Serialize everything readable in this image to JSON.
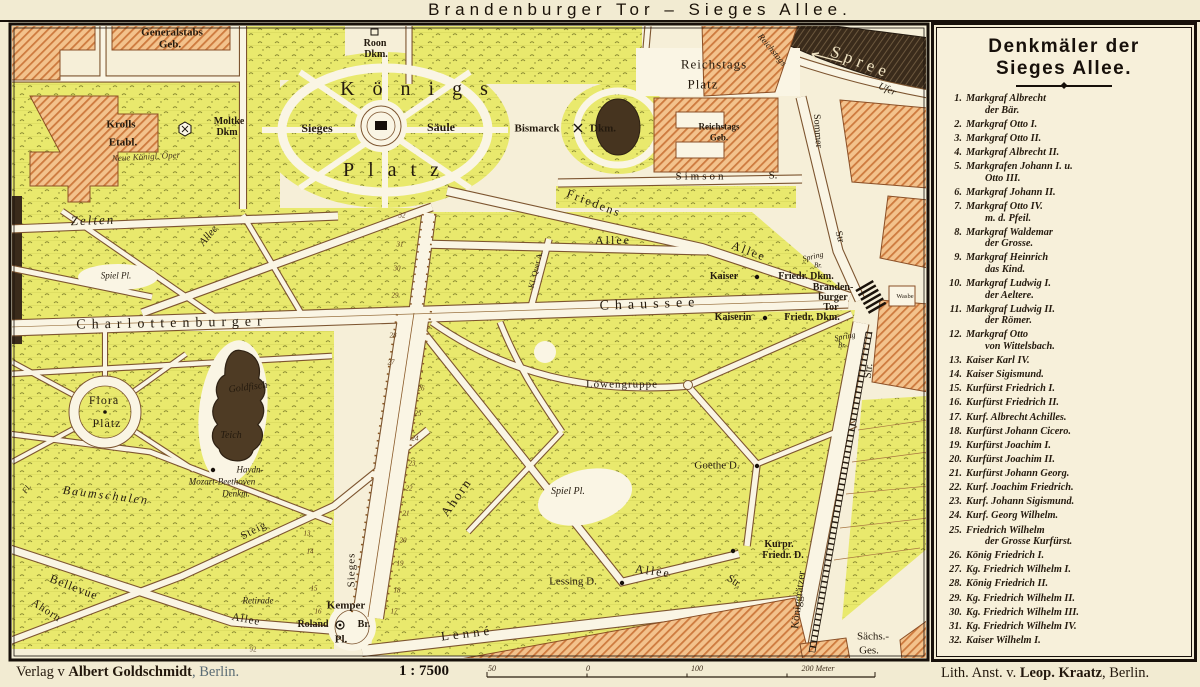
{
  "title": "Brandenburger Tor  –  Sieges Allee.",
  "legend": {
    "title_line1": "Denkmäler der",
    "title_line2": "Sieges Allee.",
    "items": [
      {
        "num": "1.",
        "lines": [
          "Markgraf Albrecht",
          "der Bär."
        ]
      },
      {
        "num": "2.",
        "lines": [
          "Markgraf Otto I."
        ]
      },
      {
        "num": "3.",
        "lines": [
          "Markgraf Otto II."
        ]
      },
      {
        "num": "4.",
        "lines": [
          "Markgraf Albrecht II."
        ]
      },
      {
        "num": "5.",
        "lines": [
          "Markgrafen Johann I. u.",
          "Otto III."
        ]
      },
      {
        "num": "6.",
        "lines": [
          "Markgraf Johann II."
        ]
      },
      {
        "num": "7.",
        "lines": [
          "Markgraf Otto IV.",
          "m. d. Pfeil."
        ]
      },
      {
        "num": "8.",
        "lines": [
          "Markgraf Waldemar",
          "der Grosse."
        ]
      },
      {
        "num": "9.",
        "lines": [
          "Markgraf Heinrich",
          "das Kind."
        ]
      },
      {
        "num": "10.",
        "lines": [
          "Markgraf Ludwig I.",
          "der Aeltere."
        ]
      },
      {
        "num": "11.",
        "lines": [
          "Markgraf Ludwig II.",
          "der Römer."
        ]
      },
      {
        "num": "12.",
        "lines": [
          "Markgraf Otto",
          "von Wittelsbach."
        ]
      },
      {
        "num": "13.",
        "lines": [
          "Kaiser Karl IV."
        ]
      },
      {
        "num": "14.",
        "lines": [
          "Kaiser Sigismund."
        ]
      },
      {
        "num": "15.",
        "lines": [
          "Kurfürst Friedrich I."
        ]
      },
      {
        "num": "16.",
        "lines": [
          "Kurfürst Friedrich II."
        ]
      },
      {
        "num": "17.",
        "lines": [
          "Kurf. Albrecht Achilles."
        ]
      },
      {
        "num": "18.",
        "lines": [
          "Kurfürst Johann Cicero."
        ]
      },
      {
        "num": "19.",
        "lines": [
          "Kurfürst Joachim I."
        ]
      },
      {
        "num": "20.",
        "lines": [
          "Kurfürst Joachim II."
        ]
      },
      {
        "num": "21.",
        "lines": [
          "Kurfürst Johann Georg."
        ]
      },
      {
        "num": "22.",
        "lines": [
          "Kurf. Joachim Friedrich."
        ]
      },
      {
        "num": "23.",
        "lines": [
          "Kurf. Johann Sigismund."
        ]
      },
      {
        "num": "24.",
        "lines": [
          "Kurf. Georg Wilhelm."
        ]
      },
      {
        "num": "25.",
        "lines": [
          "Friedrich Wilhelm",
          "der Grosse Kurfürst."
        ]
      },
      {
        "num": "26.",
        "lines": [
          "König Friedrich I."
        ]
      },
      {
        "num": "27.",
        "lines": [
          "Kg. Friedrich Wilhelm I."
        ]
      },
      {
        "num": "28.",
        "lines": [
          "König Friedrich II."
        ]
      },
      {
        "num": "29.",
        "lines": [
          "Kg. Friedrich Wilhelm II."
        ]
      },
      {
        "num": "30.",
        "lines": [
          "Kg. Friedrich Wilhelm III."
        ]
      },
      {
        "num": "31.",
        "lines": [
          "Kg. Friedrich Wilhelm IV."
        ]
      },
      {
        "num": "32.",
        "lines": [
          "Kaiser Wilhelm I."
        ]
      }
    ]
  },
  "footer": {
    "publisher_pre": "Verlag v ",
    "publisher_bold": "Albert Goldschmidt",
    "publisher_post": ", Berlin.",
    "scale_label": "1 : 7500",
    "ticks": [
      {
        "t": "50",
        "x": 492
      },
      {
        "t": "0",
        "x": 588
      },
      {
        "t": "100",
        "x": 697
      },
      {
        "t": "200 Meter",
        "x": 818
      }
    ],
    "lith_pre": "Lith. Anst. v. ",
    "lith_bold": "Leop. Kraatz",
    "lith_post": ", Berlin."
  },
  "colors": {
    "park": "#e9e96d",
    "building": "#f3c28c",
    "building_hatch": "#cd7a3e",
    "water": "#3a2b1b",
    "road": "#faf5e4",
    "linework": "#7d5530",
    "frame": "#17100a"
  },
  "map_labels": [
    {
      "t": "Generalstabs",
      "x": 172,
      "y": 33,
      "s": 11,
      "b": 1
    },
    {
      "t": "Geb.",
      "x": 170,
      "y": 45,
      "s": 11,
      "b": 1
    },
    {
      "t": "Roon",
      "x": 375,
      "y": 44,
      "s": 10,
      "b": 1
    },
    {
      "t": "Dkm.",
      "x": 376,
      "y": 55,
      "s": 10,
      "b": 1
    },
    {
      "t": "Königs",
      "x": 423,
      "y": 89,
      "s": 20,
      "ls": 18
    },
    {
      "t": "Platz",
      "x": 398,
      "y": 170,
      "s": 20,
      "ls": 14
    },
    {
      "t": "Sieges",
      "x": 317,
      "y": 128,
      "s": 12,
      "b": 1
    },
    {
      "t": "Säule",
      "x": 441,
      "y": 127,
      "s": 12,
      "b": 1
    },
    {
      "t": "Bismarck",
      "x": 537,
      "y": 129,
      "s": 11,
      "b": 1
    },
    {
      "t": "Dkm.",
      "x": 603,
      "y": 129,
      "s": 11,
      "b": 1
    },
    {
      "t": "Reichstags",
      "x": 714,
      "y": 64,
      "s": 13,
      "ls": 1
    },
    {
      "t": "Platz",
      "x": 703,
      "y": 84,
      "s": 13,
      "ls": 1
    },
    {
      "t": "Reichstags",
      "x": 719,
      "y": 127,
      "s": 9,
      "b": 1
    },
    {
      "t": "Geb.",
      "x": 719,
      "y": 138,
      "s": 9,
      "b": 1
    },
    {
      "t": "Simson",
      "x": 701,
      "y": 177,
      "s": 11,
      "ls": 3
    },
    {
      "t": "S.",
      "x": 773,
      "y": 176,
      "s": 11
    },
    {
      "t": "Krolls",
      "x": 121,
      "y": 125,
      "s": 11,
      "b": 1
    },
    {
      "t": "Etabl.",
      "x": 123,
      "y": 143,
      "s": 11,
      "b": 1
    },
    {
      "t": "Neue Königl. Oper",
      "x": 146,
      "y": 157,
      "s": 9,
      "i": 1,
      "rot": -3,
      "c": "#4a3a22"
    },
    {
      "t": "Moltke",
      "x": 229,
      "y": 122,
      "s": 10,
      "b": 1
    },
    {
      "t": "Dkm",
      "x": 227,
      "y": 133,
      "s": 10,
      "b": 1
    },
    {
      "t": "Spree",
      "x": 861,
      "y": 62,
      "s": 17,
      "ls": 5,
      "rot": 21,
      "c": "#efe3c2"
    },
    {
      "t": "Reichstags",
      "x": 772,
      "y": 50,
      "s": 9,
      "rot": 50,
      "i": 1
    },
    {
      "t": "Ufer",
      "x": 887,
      "y": 90,
      "s": 10,
      "rot": 24,
      "i": 1
    },
    {
      "t": "Sommer",
      "x": 817,
      "y": 131,
      "s": 10,
      "rot": 86
    },
    {
      "t": "Str",
      "x": 839,
      "y": 237,
      "s": 10,
      "rot": 75
    },
    {
      "t": "Zelten",
      "x": 93,
      "y": 220,
      "s": 13,
      "i": 1,
      "ls": 2,
      "rot": -2
    },
    {
      "t": "Allee",
      "x": 209,
      "y": 236,
      "s": 11,
      "i": 1,
      "rot": -50
    },
    {
      "t": "Friedens",
      "x": 594,
      "y": 203,
      "s": 12,
      "ls": 2,
      "rot": 21
    },
    {
      "t": "Allee",
      "x": 613,
      "y": 240,
      "s": 12,
      "ls": 2
    },
    {
      "t": "Allee",
      "x": 749,
      "y": 251,
      "s": 12,
      "ls": 2,
      "rot": 21
    },
    {
      "t": "Kl. Quer A.",
      "x": 536,
      "y": 270,
      "s": 8,
      "rot": -76
    },
    {
      "t": "Charlottenburger",
      "x": 172,
      "y": 324,
      "s": 14,
      "ls": 6,
      "rot": -1
    },
    {
      "t": "Chaussee",
      "x": 650,
      "y": 305,
      "s": 14,
      "ls": 6,
      "rot": -2
    },
    {
      "t": "Spiel Pl.",
      "x": 116,
      "y": 276,
      "s": 9,
      "i": 1
    },
    {
      "t": "Kaiser",
      "x": 724,
      "y": 277,
      "s": 10,
      "b": 1
    },
    {
      "t": "Friedr. Dkm.",
      "x": 806,
      "y": 277,
      "s": 10,
      "b": 1
    },
    {
      "t": "Branden-",
      "x": 833,
      "y": 288,
      "s": 10,
      "b": 1
    },
    {
      "t": "burger",
      "x": 833,
      "y": 298,
      "s": 10,
      "b": 1
    },
    {
      "t": "Tor",
      "x": 831,
      "y": 308,
      "s": 10,
      "b": 1
    },
    {
      "t": "Kaiserin",
      "x": 733,
      "y": 318,
      "s": 10,
      "b": 1
    },
    {
      "t": "Friedr. Dkm.",
      "x": 812,
      "y": 318,
      "s": 10,
      "b": 1
    },
    {
      "t": "Spring",
      "x": 813,
      "y": 257,
      "s": 8,
      "i": 1,
      "rot": -14
    },
    {
      "t": "Br.",
      "x": 818,
      "y": 266,
      "s": 7,
      "i": 1
    },
    {
      "t": "Spring",
      "x": 845,
      "y": 337,
      "s": 8,
      "i": 1,
      "rot": -10
    },
    {
      "t": "Br.",
      "x": 842,
      "y": 346,
      "s": 7,
      "i": 1
    },
    {
      "t": "Wasbe",
      "x": 905,
      "y": 297,
      "s": 6.5
    },
    {
      "t": "Flora",
      "x": 104,
      "y": 400,
      "s": 12,
      "ls": 1
    },
    {
      "t": "Platz",
      "x": 107,
      "y": 423,
      "s": 12,
      "ls": 1
    },
    {
      "t": "Goldfisch",
      "x": 248,
      "y": 388,
      "s": 10,
      "i": 1,
      "rot": -7
    },
    {
      "t": "Teich",
      "x": 231,
      "y": 436,
      "s": 10,
      "i": 1
    },
    {
      "t": "Haydn-",
      "x": 250,
      "y": 470,
      "s": 9,
      "i": 1
    },
    {
      "t": "Mozart-Beethoven",
      "x": 222,
      "y": 482,
      "s": 9,
      "i": 1
    },
    {
      "t": "Denkm.",
      "x": 236,
      "y": 494,
      "s": 9,
      "i": 1
    },
    {
      "t": "Baumschulen",
      "x": 106,
      "y": 495,
      "s": 12,
      "i": 1,
      "rot": 7,
      "ls": 2
    },
    {
      "t": "Fl.",
      "x": 27,
      "y": 489,
      "s": 8,
      "i": 1,
      "rot": -55
    },
    {
      "t": "Bellevue",
      "x": 74,
      "y": 587,
      "s": 12,
      "ls": 1,
      "rot": 21
    },
    {
      "t": "Ahorn",
      "x": 46,
      "y": 611,
      "s": 11,
      "ls": 1,
      "rot": 33
    },
    {
      "t": "Steig",
      "x": 254,
      "y": 531,
      "s": 11,
      "ls": 1,
      "rot": -27
    },
    {
      "t": "Retirade",
      "x": 258,
      "y": 601,
      "s": 9,
      "i": 1
    },
    {
      "t": "Allee",
      "x": 246,
      "y": 620,
      "s": 11,
      "ls": 1,
      "rot": 11
    },
    {
      "t": "Kemper",
      "x": 346,
      "y": 606,
      "s": 11,
      "b": 1
    },
    {
      "t": "Roland",
      "x": 313,
      "y": 625,
      "s": 10,
      "b": 1
    },
    {
      "t": "Br.",
      "x": 364,
      "y": 625,
      "s": 10,
      "b": 1
    },
    {
      "t": "Pl.",
      "x": 341,
      "y": 640,
      "s": 11,
      "b": 1
    },
    {
      "t": "Lenné",
      "x": 467,
      "y": 633,
      "s": 13,
      "ls": 4,
      "rot": -7
    },
    {
      "t": "Sieges",
      "x": 352,
      "y": 570,
      "s": 11,
      "rot": -90,
      "ls": 1
    },
    {
      "t": "Ahorn",
      "x": 456,
      "y": 497,
      "s": 13,
      "ls": 2,
      "rot": -55
    },
    {
      "t": "Spiel Pl.",
      "x": 568,
      "y": 492,
      "s": 10,
      "i": 1
    },
    {
      "t": "Löwengruppe",
      "x": 622,
      "y": 385,
      "s": 11,
      "ls": 1
    },
    {
      "t": "Goethe D.",
      "x": 717,
      "y": 466,
      "s": 11
    },
    {
      "t": "Kurpr.",
      "x": 779,
      "y": 545,
      "s": 10,
      "b": 1
    },
    {
      "t": "Friedr. D.",
      "x": 783,
      "y": 556,
      "s": 10,
      "b": 1
    },
    {
      "t": "Lessing D.",
      "x": 573,
      "y": 582,
      "s": 11
    },
    {
      "t": "Allee",
      "x": 653,
      "y": 571,
      "s": 12,
      "ls": 2,
      "rot": 8
    },
    {
      "t": "Str.",
      "x": 734,
      "y": 582,
      "s": 11,
      "rot": 33
    },
    {
      "t": "Königgrätzer",
      "x": 799,
      "y": 600,
      "s": 11,
      "rot": -83
    },
    {
      "t": "Str.",
      "x": 869,
      "y": 371,
      "s": 11,
      "rot": -83
    },
    {
      "t": "Sächs.-",
      "x": 873,
      "y": 637,
      "s": 11
    },
    {
      "t": "Ges.",
      "x": 869,
      "y": 651,
      "s": 11
    },
    {
      "t": "92",
      "x": 253,
      "y": 650,
      "s": 7,
      "c": "#6b573d"
    }
  ],
  "monument_numbers": [
    {
      "n": "32",
      "x": 402,
      "y": 216
    },
    {
      "n": "31",
      "x": 400,
      "y": 245
    },
    {
      "n": "30",
      "x": 397,
      "y": 269
    },
    {
      "n": "29",
      "x": 395,
      "y": 296
    },
    {
      "n": "28",
      "x": 393,
      "y": 336
    },
    {
      "n": "27",
      "x": 391,
      "y": 363
    },
    {
      "n": "26",
      "x": 421,
      "y": 389
    },
    {
      "n": "25",
      "x": 418,
      "y": 414
    },
    {
      "n": "24",
      "x": 415,
      "y": 439
    },
    {
      "n": "23",
      "x": 412,
      "y": 464
    },
    {
      "n": "22",
      "x": 409,
      "y": 489
    },
    {
      "n": "21",
      "x": 406,
      "y": 514
    },
    {
      "n": "20",
      "x": 403,
      "y": 541
    },
    {
      "n": "19",
      "x": 400,
      "y": 564
    },
    {
      "n": "18",
      "x": 397,
      "y": 591
    },
    {
      "n": "17",
      "x": 394,
      "y": 612
    },
    {
      "n": "16",
      "x": 318,
      "y": 612
    },
    {
      "n": "15",
      "x": 314,
      "y": 589
    },
    {
      "n": "14",
      "x": 310,
      "y": 552
    },
    {
      "n": "13",
      "x": 307,
      "y": 534
    }
  ]
}
